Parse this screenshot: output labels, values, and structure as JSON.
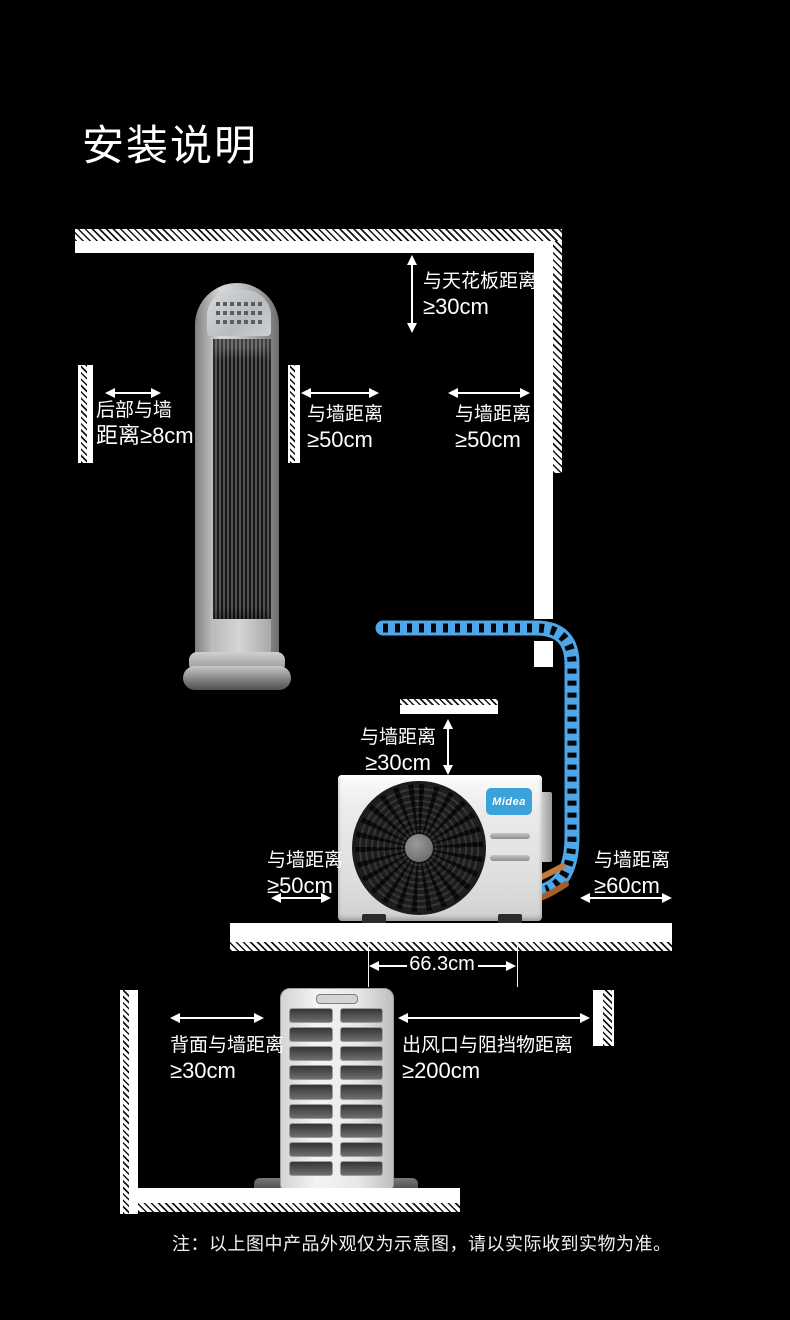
{
  "page": {
    "title": "安装说明",
    "note": "注：以上图中产品外观仅为示意图，请以实际收到实物为准。"
  },
  "indoor": {
    "ceiling_clearance": {
      "l1": "与天花板距离",
      "l2": "≥30cm"
    },
    "back_clearance": {
      "l1": "后部与墙",
      "l2": "距离≥8cm"
    },
    "left_wall_clearance": {
      "l1": "与墙距离",
      "l2": "≥50cm"
    },
    "right_wall_clearance": {
      "l1": "与墙距离",
      "l2": "≥50cm"
    }
  },
  "outdoor": {
    "brand": "Midea",
    "top_clearance": {
      "l1": "与墙距离",
      "l2": "≥30cm"
    },
    "left_clearance": {
      "l1": "与墙距离",
      "l2": "≥50cm"
    },
    "right_clearance": {
      "l1": "与墙距离",
      "l2": "≥60cm"
    },
    "unit_width": "66.3cm"
  },
  "rear": {
    "back_clearance": {
      "l1": "背面与墙距离",
      "l2": "≥30cm"
    },
    "front_clearance": {
      "l1": "出风口与阻挡物距离",
      "l2": "≥200cm"
    }
  },
  "colors": {
    "background": "#000000",
    "text": "#ffffff",
    "pipe_blue": "#4da7e8",
    "brand_blue": "#3aa2db",
    "copper": "#c47a3e"
  }
}
